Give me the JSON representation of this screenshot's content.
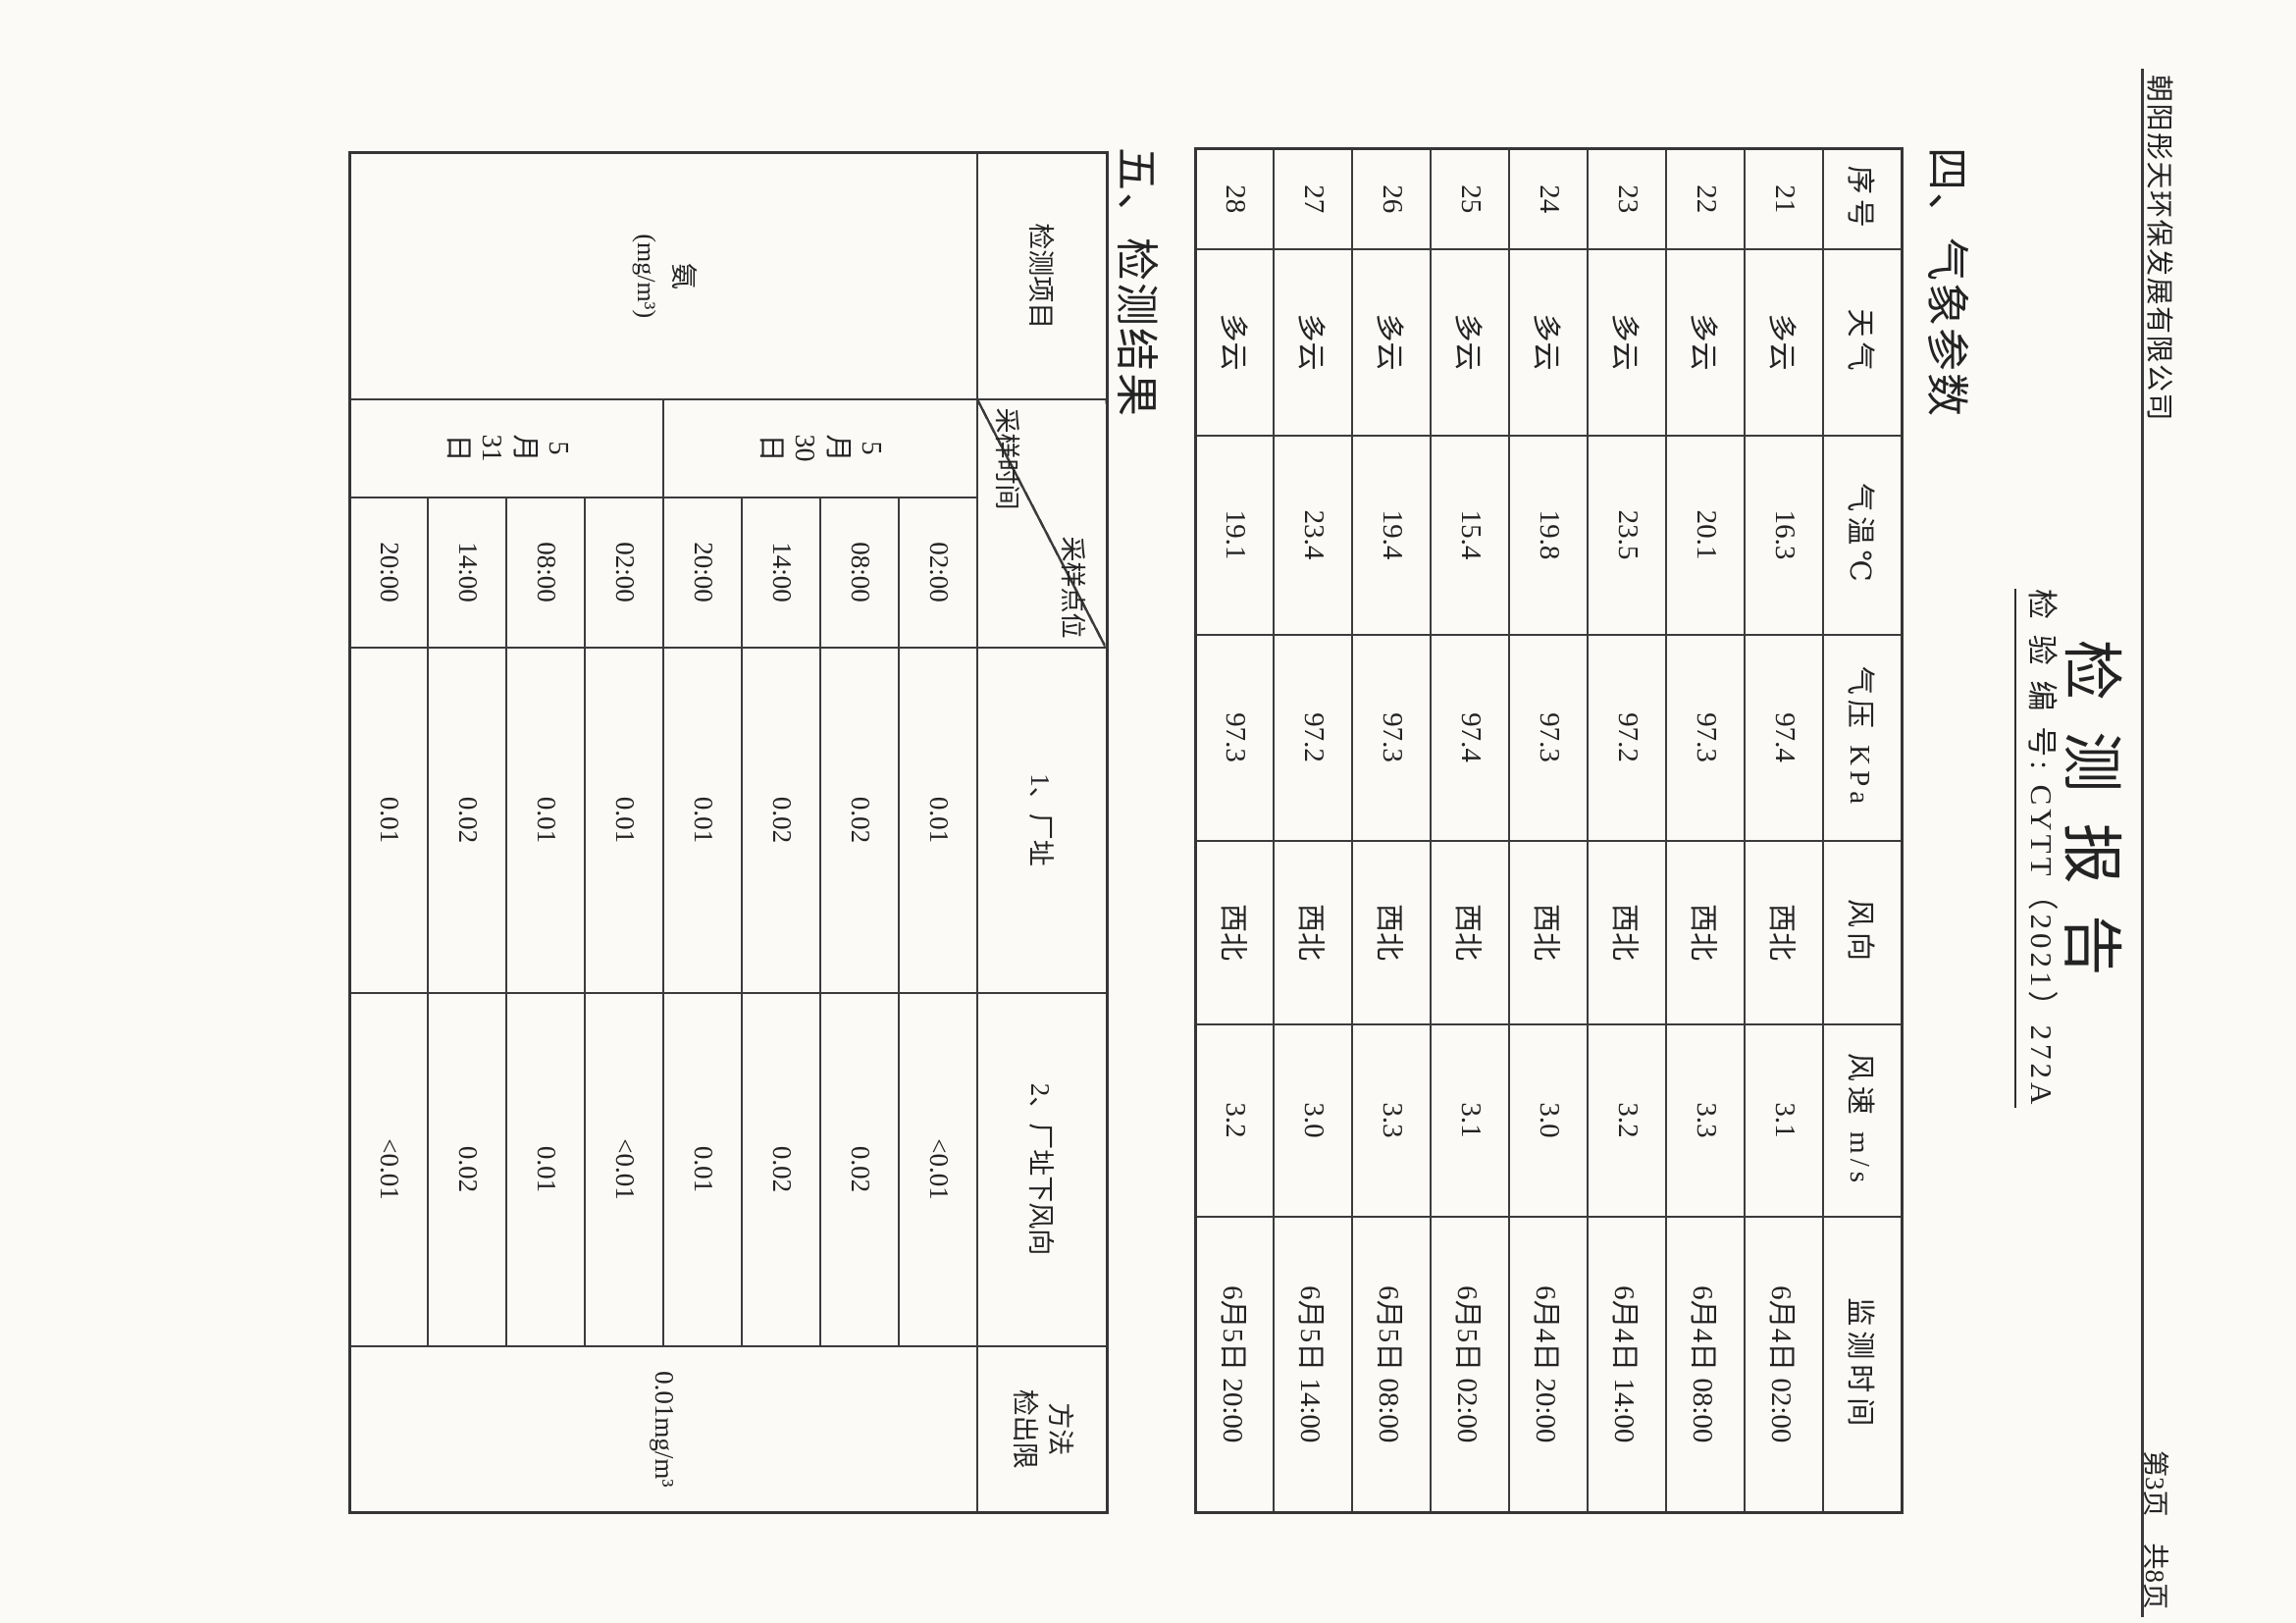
{
  "header": {
    "company": "朝阳彤天环保发展有限公司",
    "page_indicator": "第3页　共8页"
  },
  "title_block": {
    "title": "检 测 报 告",
    "report_no": "检 验 编 号: CYTT（2021）272A"
  },
  "sections": {
    "weather": "四、气象参数",
    "results": "五、检测结果"
  },
  "weather_table": {
    "headers": {
      "seq": "序号",
      "weather": "天气",
      "temp": "气温℃",
      "pressure": "气压 KPa",
      "wind_dir": "风向",
      "wind_speed": "风速 m/s",
      "time": "监测时间"
    },
    "rows": [
      {
        "seq": "21",
        "weather": "多云",
        "temp": "16.3",
        "pressure": "97.4",
        "wind_dir": "西北",
        "wind_speed": "3.1",
        "time": "6月4日 02:00"
      },
      {
        "seq": "22",
        "weather": "多云",
        "temp": "20.1",
        "pressure": "97.3",
        "wind_dir": "西北",
        "wind_speed": "3.3",
        "time": "6月4日 08:00"
      },
      {
        "seq": "23",
        "weather": "多云",
        "temp": "23.5",
        "pressure": "97.2",
        "wind_dir": "西北",
        "wind_speed": "3.2",
        "time": "6月4日 14:00"
      },
      {
        "seq": "24",
        "weather": "多云",
        "temp": "19.8",
        "pressure": "97.3",
        "wind_dir": "西北",
        "wind_speed": "3.0",
        "time": "6月4日 20:00"
      },
      {
        "seq": "25",
        "weather": "多云",
        "temp": "15.4",
        "pressure": "97.4",
        "wind_dir": "西北",
        "wind_speed": "3.1",
        "time": "6月5日 02:00"
      },
      {
        "seq": "26",
        "weather": "多云",
        "temp": "19.4",
        "pressure": "97.3",
        "wind_dir": "西北",
        "wind_speed": "3.3",
        "time": "6月5日 08:00"
      },
      {
        "seq": "27",
        "weather": "多云",
        "temp": "23.4",
        "pressure": "97.2",
        "wind_dir": "西北",
        "wind_speed": "3.0",
        "time": "6月5日 14:00"
      },
      {
        "seq": "28",
        "weather": "多云",
        "temp": "19.1",
        "pressure": "97.3",
        "wind_dir": "西北",
        "wind_speed": "3.2",
        "time": "6月5日 20:00"
      }
    ]
  },
  "result_table": {
    "headers": {
      "item": "检测项目",
      "diag_top": "采样点位",
      "diag_bottom": "采样时间",
      "site1": "1、厂址",
      "site2": "2、厂址下风向",
      "limit_line1": "方法",
      "limit_line2": "检出限"
    },
    "sample_item": {
      "name": "氨",
      "unit": "(mg/m³)"
    },
    "date_groups": [
      {
        "lines": [
          "5",
          "月",
          "30",
          "日"
        ]
      },
      {
        "lines": [
          "5",
          "月",
          "31",
          "日"
        ]
      }
    ],
    "rows": [
      {
        "time": "02:00",
        "site1": "0.01",
        "site2": "<0.01"
      },
      {
        "time": "08:00",
        "site1": "0.02",
        "site2": "0.02"
      },
      {
        "time": "14:00",
        "site1": "0.02",
        "site2": "0.02"
      },
      {
        "time": "20:00",
        "site1": "0.01",
        "site2": "0.01"
      },
      {
        "time": "02:00",
        "site1": "0.01",
        "site2": "<0.01"
      },
      {
        "time": "08:00",
        "site1": "0.01",
        "site2": "0.01"
      },
      {
        "time": "14:00",
        "site1": "0.02",
        "site2": "0.02"
      },
      {
        "time": "20:00",
        "site1": "0.01",
        "site2": "<0.01"
      }
    ],
    "detection_limit": "0.01mg/m³"
  }
}
